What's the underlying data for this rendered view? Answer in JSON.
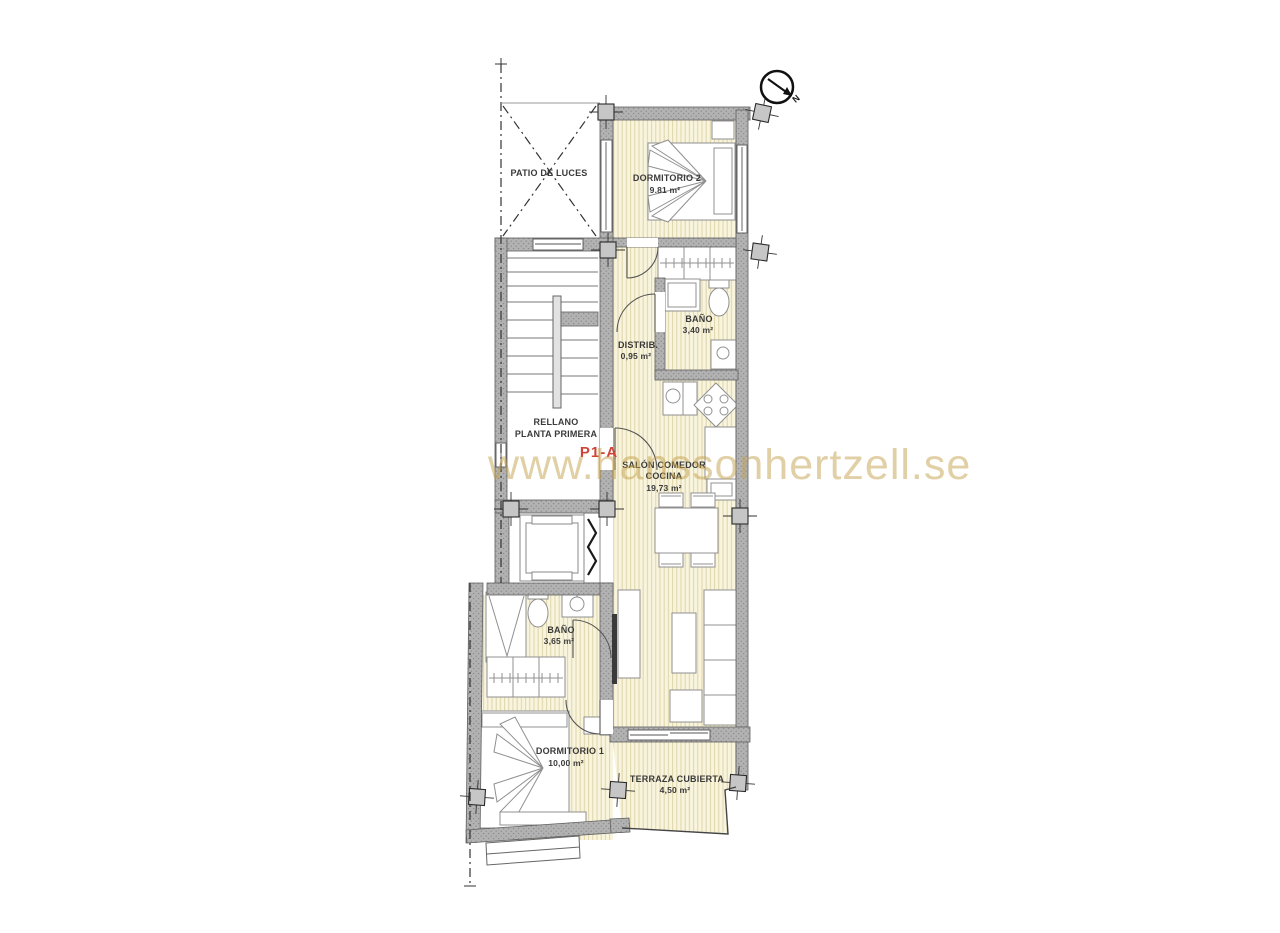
{
  "watermark": {
    "text": "www.hanssonhertzell.se",
    "color": "#c5a14e"
  },
  "plan": {
    "unit_code": "P1-A",
    "unit_code_color": "#cf4437",
    "north_label": "N",
    "rooms": {
      "patio": {
        "name": "PATIO DE LUCES"
      },
      "dormitorio2": {
        "name": "DORMITORIO 2",
        "area": "9.81 m²"
      },
      "bano2": {
        "name": "BAÑO",
        "area": "3,40 m²"
      },
      "distribuidor": {
        "name": "DISTRIB.",
        "area": "0,95 m²"
      },
      "rellano": {
        "line1": "RELLANO",
        "line2": "PLANTA PRIMERA"
      },
      "salon": {
        "line1": "SALÓN COMEDOR",
        "line2": "COCINA",
        "area": "19,73 m²"
      },
      "bano1": {
        "name": "BAÑO",
        "area": "3,65 m²"
      },
      "dormitorio1": {
        "name": "DORMITORIO 1",
        "area": "10,00 m²"
      },
      "terraza": {
        "name": "TERRAZA CUBIERTA",
        "area": "4,50 m²"
      }
    },
    "colors": {
      "floor": "#f8f4dd",
      "floor_stripe": "#dcd2a4",
      "wall_fill": "#b2b2b2",
      "wall_speckle": "#8d8d8d",
      "line": "#555555",
      "label": "#3a3a3a"
    }
  }
}
